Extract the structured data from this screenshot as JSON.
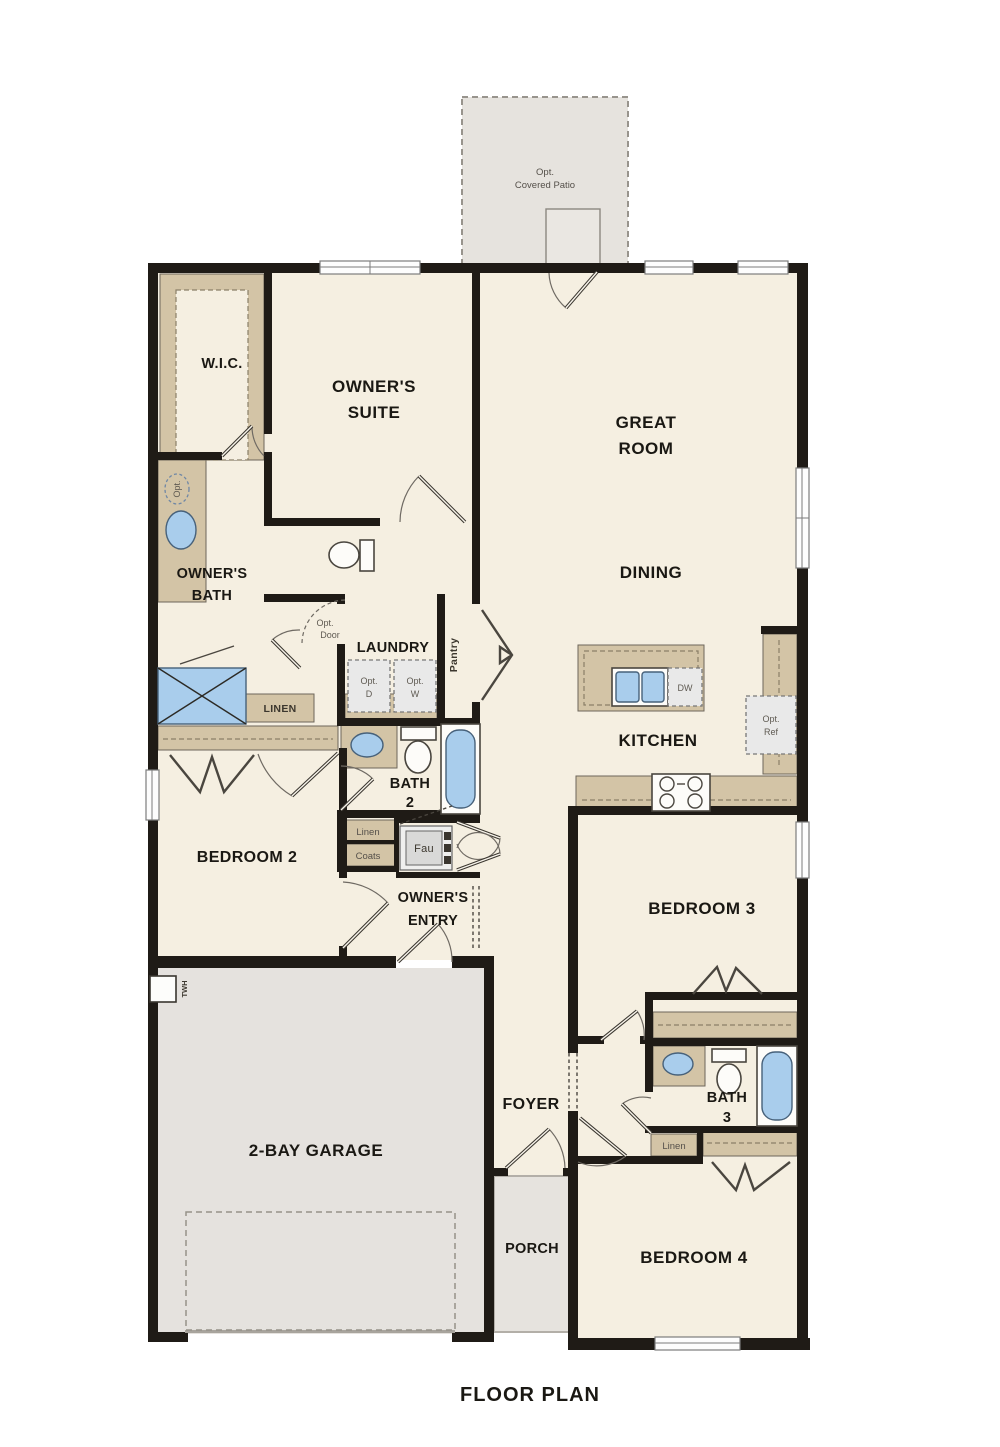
{
  "title": "FLOOR PLAN",
  "colors": {
    "wall": "#1f1b16",
    "floor": "#f5efe1",
    "accent_tan": "#d3c4a6",
    "concrete": "#e5e2de",
    "fixture_blue": "#a9cdec",
    "appliance_gray": "#e9e9e9"
  },
  "patio": {
    "line1": "Opt.",
    "line2": "Covered Patio"
  },
  "rooms": {
    "wic": "W.I.C.",
    "owners_suite": [
      "OWNER'S",
      "SUITE"
    ],
    "great_room": [
      "GREAT",
      "ROOM"
    ],
    "owners_bath": [
      "OWNER'S",
      "BATH"
    ],
    "dining": "DINING",
    "laundry": "LAUNDRY",
    "pantry": "Pantry",
    "kitchen": "KITCHEN",
    "bath2": [
      "BATH",
      "2"
    ],
    "owners_entry": [
      "OWNER'S",
      "ENTRY"
    ],
    "bedroom2": "BEDROOM 2",
    "bedroom3": "BEDROOM 3",
    "foyer": "FOYER",
    "bath3": [
      "BATH",
      "3"
    ],
    "garage": "2-BAY GARAGE",
    "porch": "PORCH",
    "bedroom4": "BEDROOM 4"
  },
  "closets": {
    "linen_hall": "LINEN",
    "linen_small": "Linen",
    "coats": "Coats",
    "linen_bath3": "Linen"
  },
  "fixtures": {
    "opt_door": [
      "Opt.",
      "Door"
    ],
    "opt_dryer": [
      "Opt.",
      "D"
    ],
    "opt_washer": [
      "Opt.",
      "W"
    ],
    "dishwasher": "DW",
    "opt_fridge": [
      "Opt.",
      "Ref"
    ],
    "furnace": "Fau",
    "water_heater": "TWH",
    "opt_sink": "Opt."
  }
}
